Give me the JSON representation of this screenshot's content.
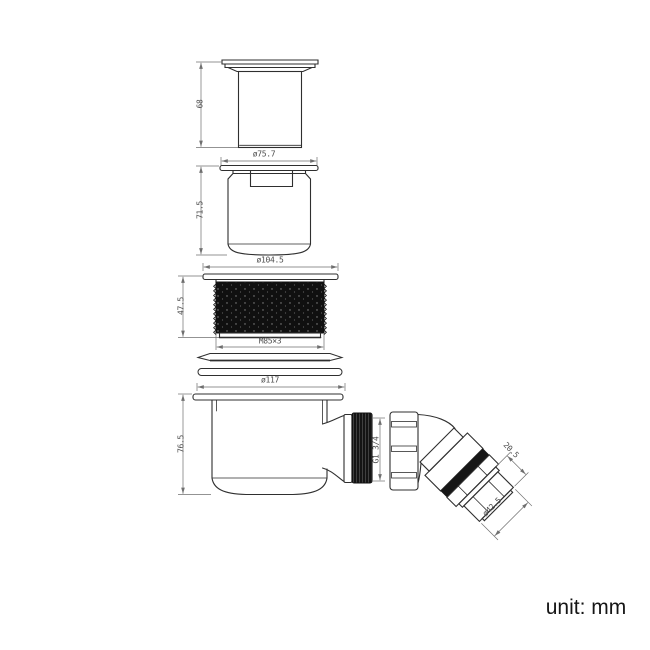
{
  "drawing": {
    "unit_note": "unit: mm",
    "dimensions": {
      "cap_height": "68",
      "insert_flange_diameter": "ø75.7",
      "insert_height": "71.5",
      "locknut_flange_diameter": "ø104.5",
      "locknut_height": "47.5",
      "locknut_thread": "M85×3",
      "trap_flange_diameter": "ø117",
      "trap_height": "76.5",
      "outlet_thread": "G1 3/4",
      "elbow_tail_length": "20.5",
      "elbow_outlet_diameter": "ø42.5"
    },
    "colors": {
      "line": "#2f2f2f",
      "dim_line": "#6f6f6f",
      "dim_text": "#4d4d4d",
      "fill_dark": "#121212",
      "background": "#ffffff"
    }
  }
}
